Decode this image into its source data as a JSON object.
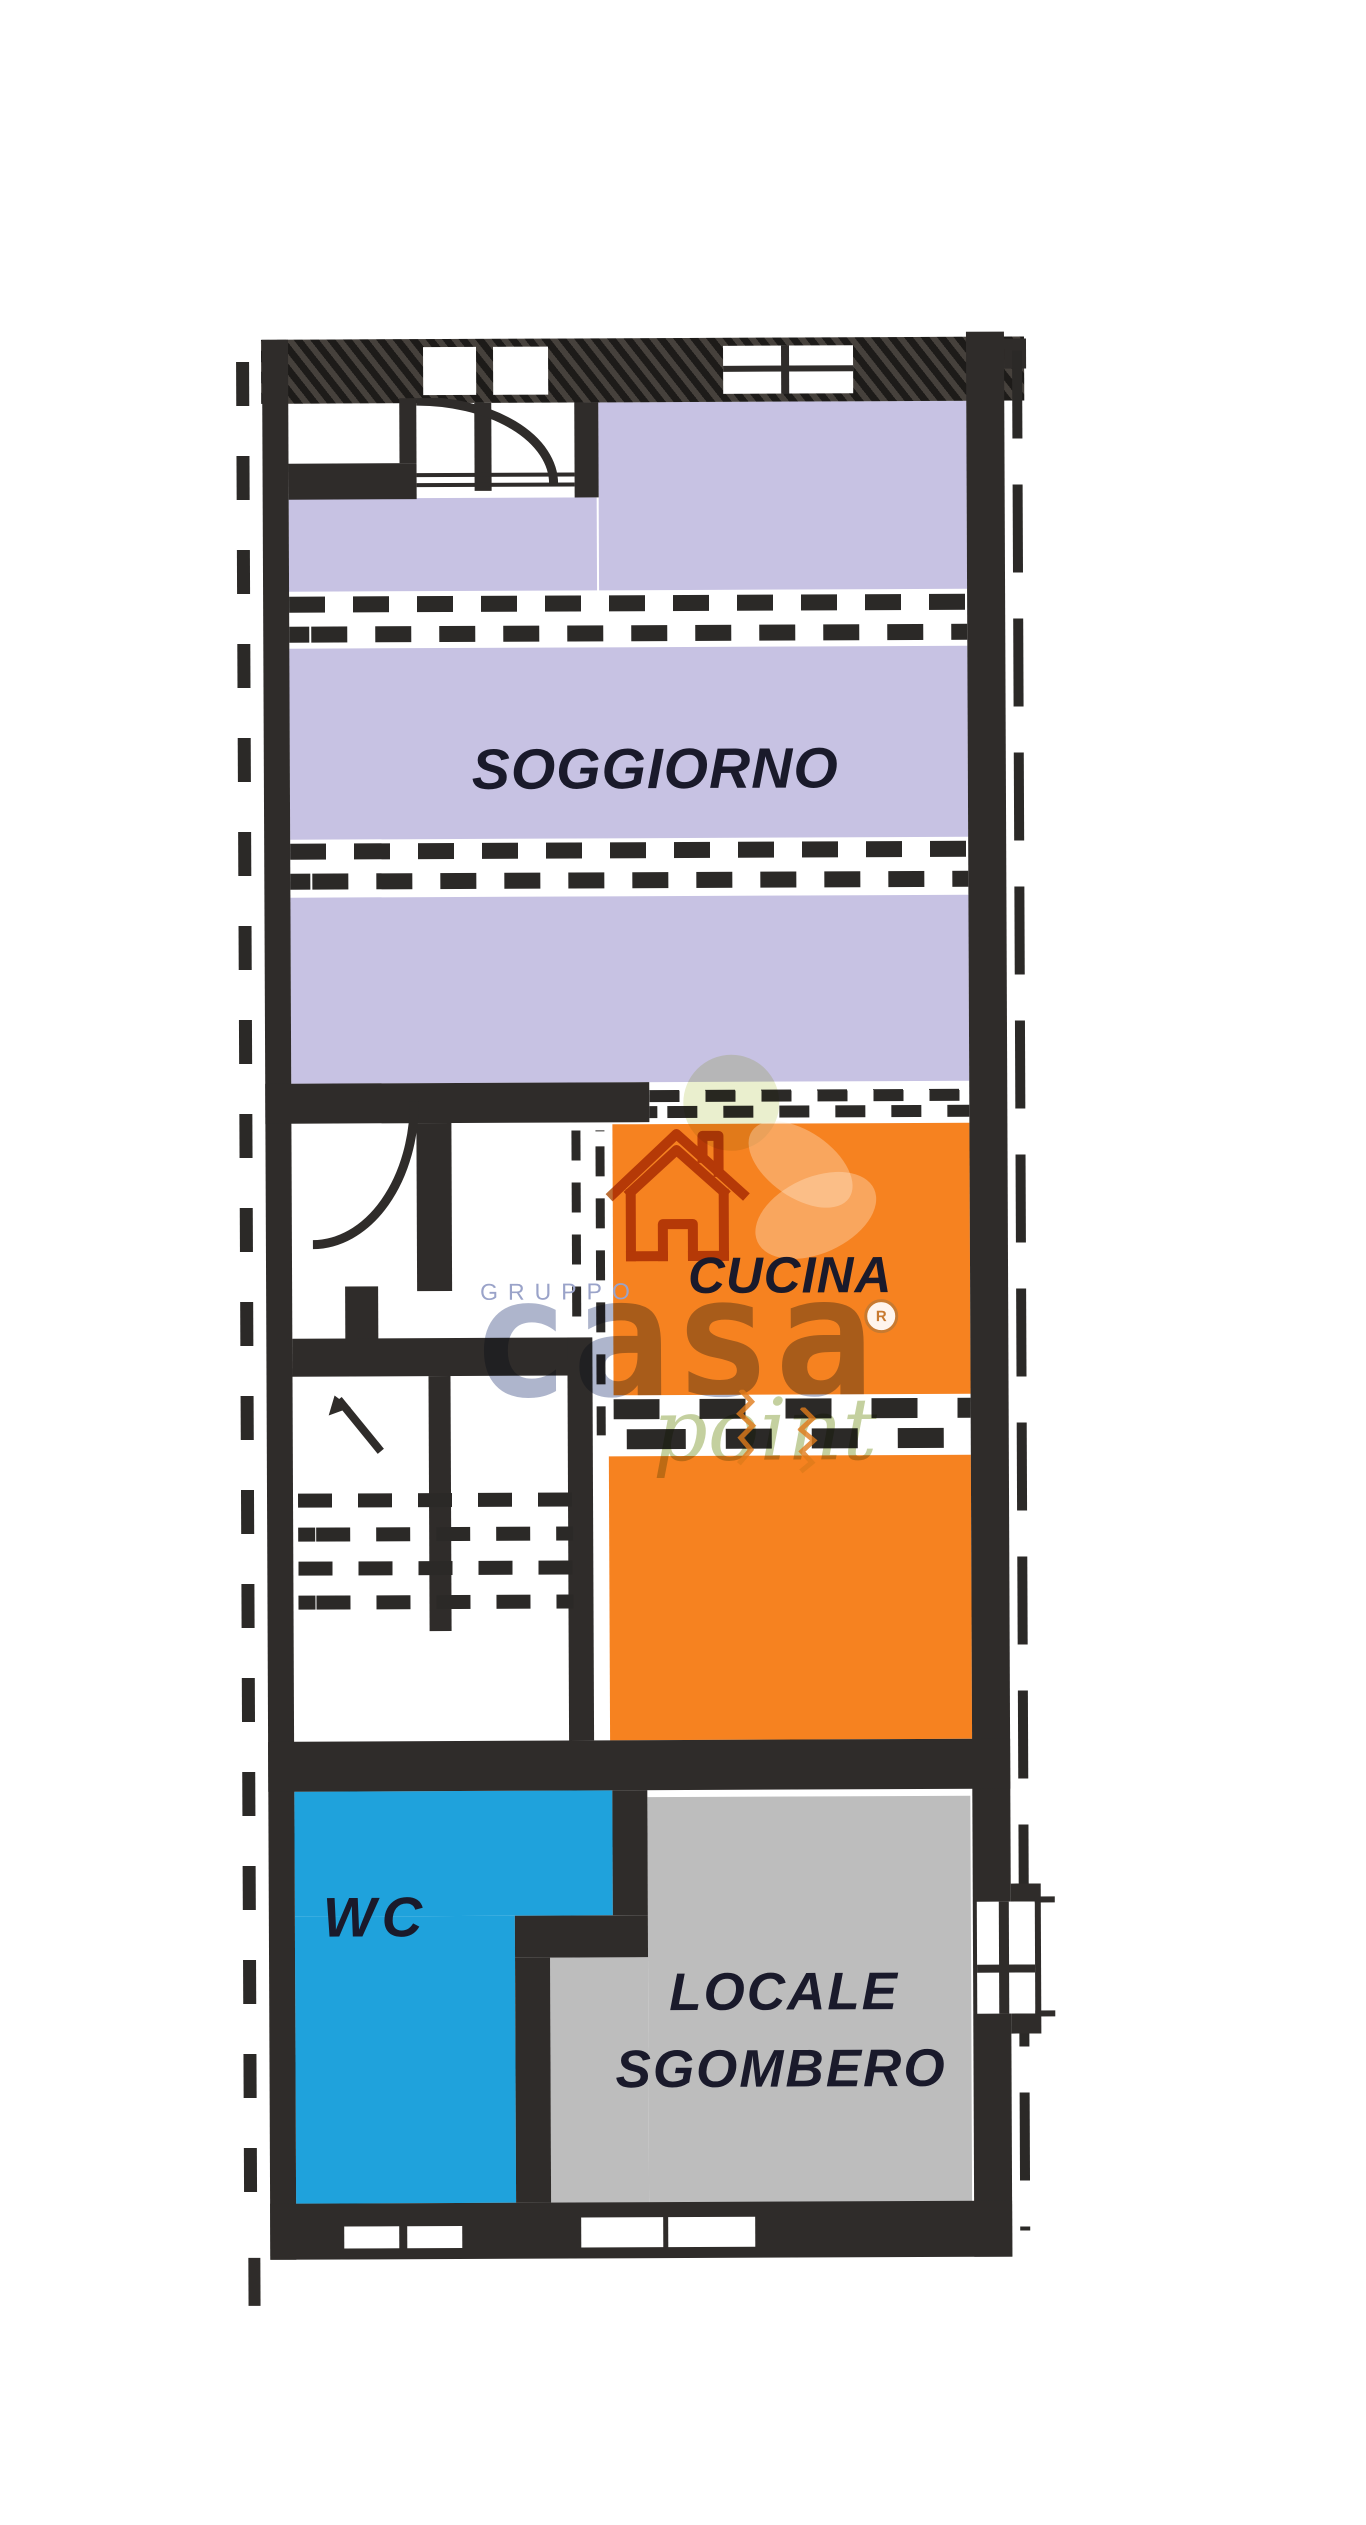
{
  "page": {
    "background": "#ffffff"
  },
  "floorplan": {
    "wall_color": "#2f2c2a",
    "rooms": [
      {
        "id": "soggiorno",
        "label": "SOGGIORNO",
        "color": "#c7c2e3"
      },
      {
        "id": "cucina",
        "label": "CUCINA",
        "color": "#f68220"
      },
      {
        "id": "wc",
        "label": "WC",
        "color": "#1fa2dc"
      },
      {
        "id": "locale-sgombero",
        "label_line1": "LOCALE",
        "label_line2": "SGOMBERO",
        "color": "#bdbdbd"
      }
    ]
  },
  "watermark": {
    "group_text": "GRUPPO",
    "brand_text": "casa",
    "registered_letter": "R",
    "script_text": "point",
    "group_color": "#9aa3c9",
    "brand_color": "#7c88ad",
    "script_color": "#9cb05f",
    "house_icon_color": "#b05513"
  }
}
